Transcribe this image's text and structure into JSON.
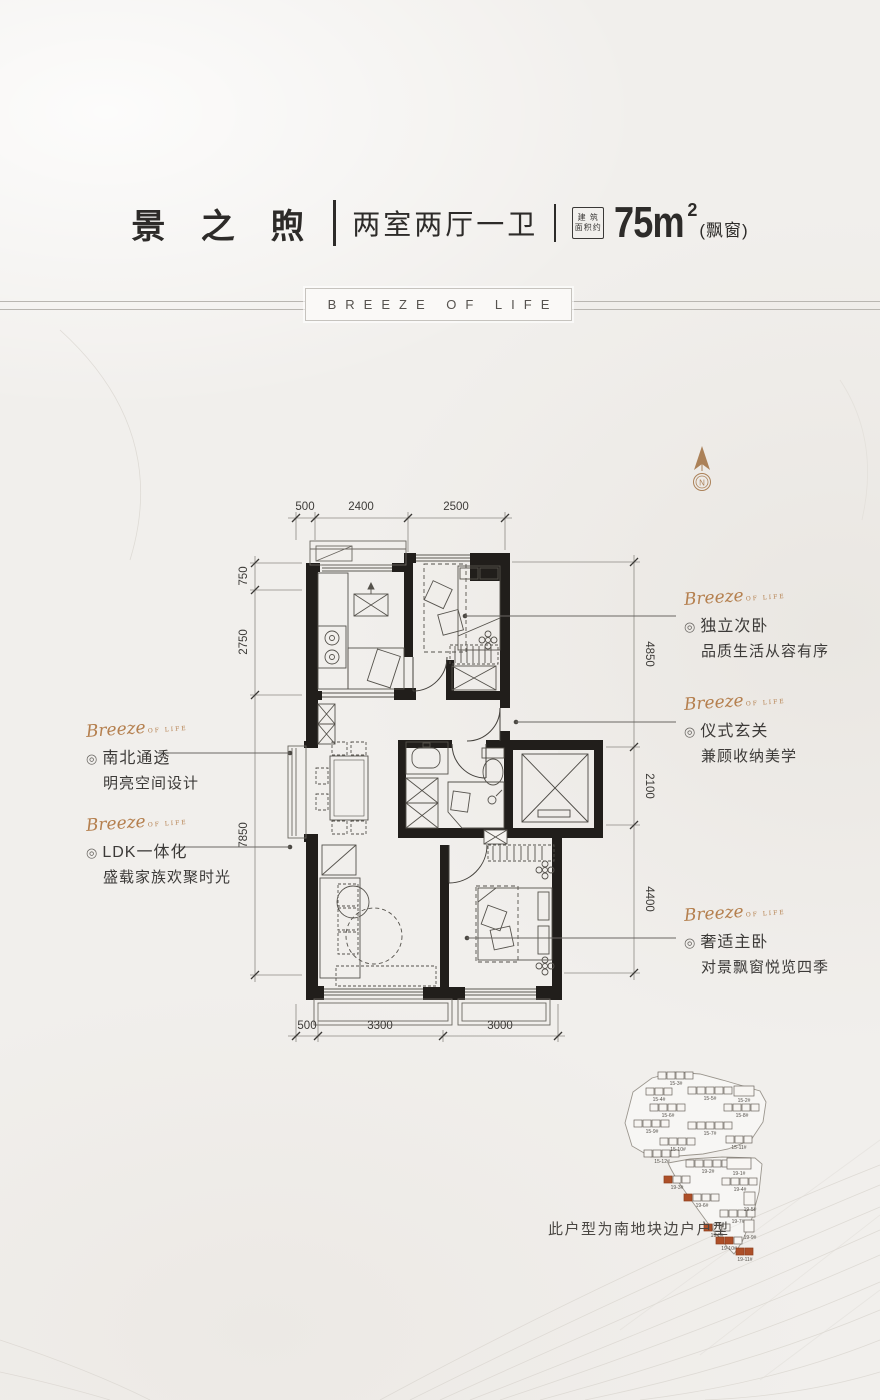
{
  "header": {
    "title": "景 之 煦",
    "layout_type": "两室两厅一卫",
    "area_badge_line1": "建 筑",
    "area_badge_line2": "面积约",
    "area_value": "75m",
    "area_superscript": "2",
    "area_suffix": "(飘窗)"
  },
  "banner": {
    "text": "BREEZE OF LIFE"
  },
  "compass": {
    "label": "N"
  },
  "dimensions": {
    "top": [
      "500",
      "2400",
      "2500"
    ],
    "left": [
      "750",
      "2750",
      "7850"
    ],
    "right": [
      "4850",
      "2100",
      "4400"
    ],
    "bottom": [
      "500",
      "3300",
      "3000"
    ]
  },
  "annotations": {
    "script_word": "Breeze",
    "script_sub": "OF LIFE",
    "bullet": "◎",
    "right": [
      {
        "title": "独立次卧",
        "desc": "品质生活从容有序"
      },
      {
        "title": "仪式玄关",
        "desc": "兼顾收纳美学"
      },
      {
        "title": "奢适主卧",
        "desc": "对景飘窗悦览四季"
      }
    ],
    "left": [
      {
        "title": "南北通透",
        "desc": "明亮空间设计"
      },
      {
        "title": "LDK一体化",
        "desc": "盛载家族欢聚时光"
      }
    ]
  },
  "sitemap": {
    "note": "此户型为南地块边户户型",
    "north": [
      {
        "label": "15-3#"
      },
      {
        "label": "15-4#"
      },
      {
        "label": "15-5#"
      },
      {
        "label": "15-2#"
      },
      {
        "label": "15-6#"
      },
      {
        "label": "15-8#"
      },
      {
        "label": "15-9#"
      },
      {
        "label": "15-7#"
      },
      {
        "label": "15-10#"
      },
      {
        "label": "15-11#"
      },
      {
        "label": "15-12#"
      }
    ],
    "south": [
      {
        "label": "19-2#"
      },
      {
        "label": "19-1#"
      },
      {
        "label": "19-3#"
      },
      {
        "label": "19-4#"
      },
      {
        "label": "19-6#"
      },
      {
        "label": "19-5#"
      },
      {
        "label": "19-7#"
      },
      {
        "label": "19-8#"
      },
      {
        "label": "19-9#"
      },
      {
        "label": "19-10#"
      },
      {
        "label": "19-11#"
      }
    ]
  },
  "colors": {
    "accent_script": "#b5804f",
    "building_highlight": "#ad4f28",
    "wall": "#211e1b",
    "banner_line": "#b9b6b1"
  }
}
